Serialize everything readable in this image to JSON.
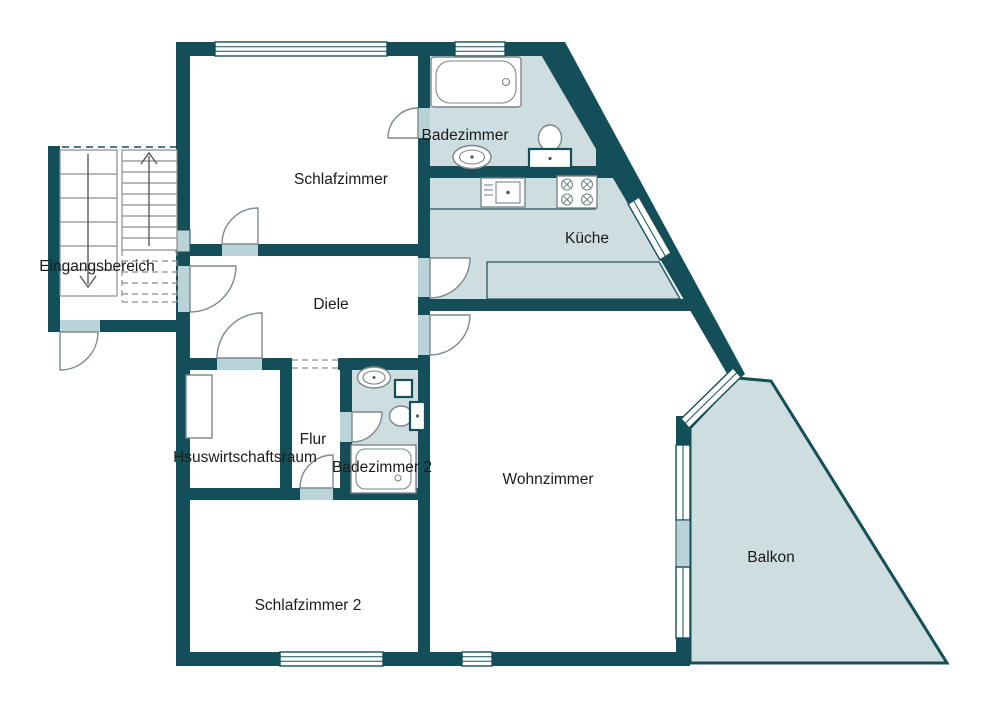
{
  "plan": {
    "type": "floor-plan",
    "language": "de"
  },
  "colors": {
    "wall": "#144E58",
    "wet_room_fill": "#CDDDE0",
    "threshold": "#B9D3D8",
    "door_stroke": "#7D898D",
    "fixture_stroke": "#79878B",
    "stair_stroke": "#8C8C8C",
    "label": "#1B1B1B",
    "background": "#FFFFFF"
  },
  "rooms": [
    {
      "id": "schlafzimmer",
      "label": "Schlafzimmer"
    },
    {
      "id": "badezimmer",
      "label": "Badezimmer"
    },
    {
      "id": "kueche",
      "label": "Küche"
    },
    {
      "id": "eingangsbereich",
      "label": "Eingangsbereich"
    },
    {
      "id": "diele",
      "label": "Diele"
    },
    {
      "id": "flur",
      "label": "Flur"
    },
    {
      "id": "hauswirtschaftsraum",
      "label": "Hsuswirtschaftsraum"
    },
    {
      "id": "badezimmer-2",
      "label": "Badezimmer 2"
    },
    {
      "id": "wohnzimmer",
      "label": "Wohnzimmer"
    },
    {
      "id": "schlafzimmer-2",
      "label": "Schlafzimmer 2"
    },
    {
      "id": "balkon",
      "label": "Balkon"
    }
  ],
  "fixtures": {
    "badezimmer": [
      "bathtub",
      "washbasin",
      "toilet"
    ],
    "kueche": [
      "kitchen-sink",
      "stove",
      "worktop",
      "lower-counter"
    ],
    "badezimmer-2": [
      "washbasin",
      "duct-shaft",
      "toilet",
      "shower"
    ],
    "hauswirtschaftsraum": [
      "closet-niche"
    ],
    "eingangsbereich": [
      "stair-flight-down",
      "stair-flight-up"
    ]
  }
}
